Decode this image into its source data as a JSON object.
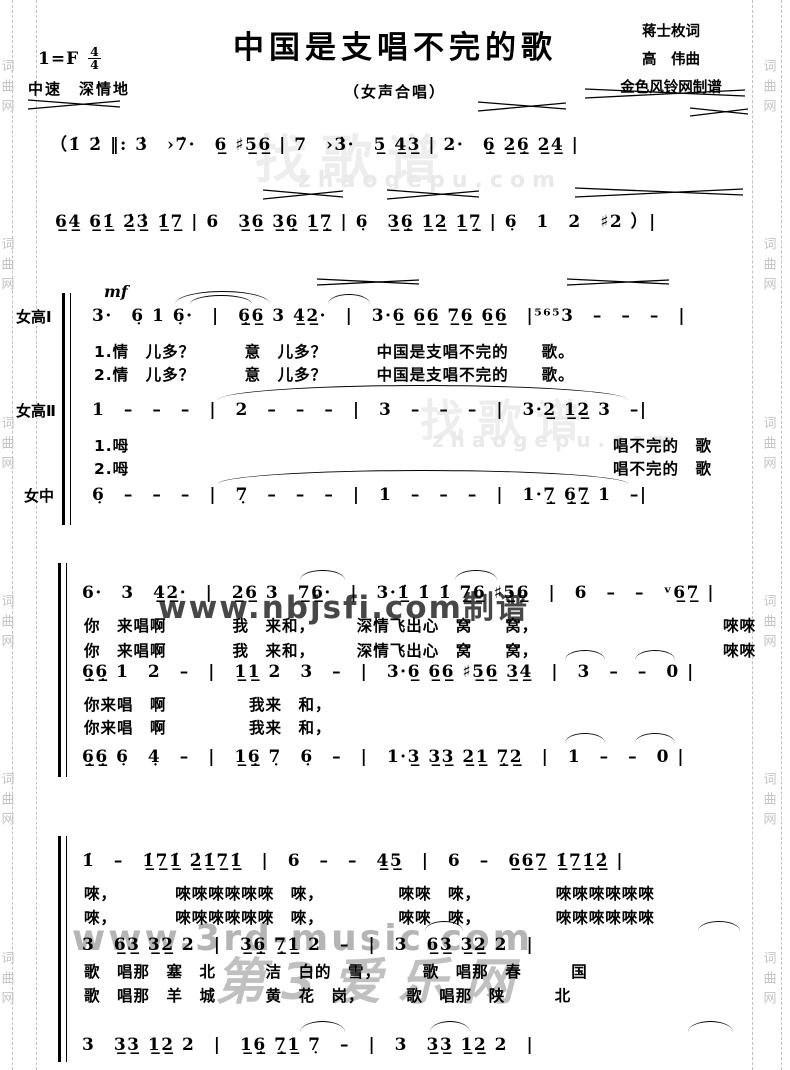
{
  "header": {
    "title": "中国是支唱不完的歌",
    "subtitle": "（女声合唱）",
    "key": "1=F",
    "meter_num": "4",
    "meter_den": "4",
    "tempo": "中速　深情地",
    "credit_lyricist": "蒋士枚词",
    "credit_composer": "高　伟曲",
    "credit_publisher": "金色风铃网制谱"
  },
  "intro": {
    "line1": "（1̇ 2̇ ‖: 3̇　›7̇·　6̲ ♯5̲6̲ | 7　›3̇·　5̲ 4̲3̲ | 2·　6̣̲ 2̲6̣̲ 2̲4̲ |",
    "line2": "6̲4̲ 6̲1̲̇ 2̲̇3̲̇ 1̲̇7̲ | 6　3̲6̲ 3̲6̣̲ 1̲7̣̲ | 6̣　3̲6̣̲ 1̲2̲ 1̲7̣̲ | 6̣　1　2　♯2 ）|"
  },
  "system1": {
    "dynamic": "mf",
    "sop1_label": "女高Ⅰ",
    "sop1_notes": "3·　6̣ 1 6̣·　|　6̣̲6̲ 3 4̲2̲·　|　3·6̲ 6̲6̲ 7̲6̲ 6̲6̲　|⁵⁶⁵3　–　–　–　|",
    "sop1_lyric1": "1.情　儿多？　　　意　儿多？　　　中国是支唱不完的　　歌。",
    "sop1_lyric2": "2.情　儿多？　　　意　儿多？　　　中国是支唱不完的　　歌。",
    "sop2_label": "女高Ⅱ",
    "sop2_notes": "1　–　–　–　|　2　–　–　–　|　3　–　–　–　|　3·2̲ 1̲2̲ 3　–|",
    "sop2_lyric1_left": "1.呣",
    "sop2_lyric1_right": "唱不完的　歌",
    "sop2_lyric2_left": "2.呣",
    "sop2_lyric2_right": "唱不完的　歌",
    "alto_label": "女中",
    "alto_notes": "6̣　–　–　–　|　7̣　–　–　–　|　1　–　–　–　|　1·7̣̲ 6̣̲7̣̲ 1　–|"
  },
  "system2": {
    "lineA_notes": "6·　3　4̲2̲·　|　2̲6̲ 3　7̲6̲·　|　3·1̲̇ 1̇ 1̇ 7̲6̲ ♯5̲6̲　|　6　–　–　ᵛ6̲7̲ |",
    "lineA_lyric1_left": "你　来唱啊　　　　我　来和，　　　深情飞出心　窝　　窝，",
    "lineA_lyric1_right": "唻唻",
    "lineA_lyric2_left": "你　来唱啊　　　　我　来和，　　　深情飞出心　窝　　窝，",
    "lineA_lyric2_right": "唻唻",
    "lineB_notes": "6̣̲6̣̲ 1　2　–　|　1̲1̲ 2　3　–　|　3·6̲ 6̲6̲ ♯5̲6̲ 3̲4̲　|　3　–　–　0 |",
    "lineB_lyric1": "你来唱　啊　　　　　我来　和，",
    "lineB_lyric2": "你来唱　啊　　　　　我来　和，",
    "lineC_notes": "6̣̲6̣̲ 6̣　4̣　–　|　1̲6̣̲ 7̣　6̣　–　|　1·3̲ 3̲3̲ 2̲1̲ 7̣̲2̲　|　1　–　–　0 |"
  },
  "system3": {
    "lineA_notes": "1̇　–　1̲̇7̲1̲̇ 2̲̇1̲̇7̲1̲̇　|　6　–　–　4̲5̲　|　6　–　6̲6̲7̲ 1̲̇7̲1̲̇2̲̇ |",
    "lineA_lyric1": "唻，　　　　唻唻唻唻唻唻　唻，　　　　　唻唻　唻，　　　　　唻唻唻唻唻唻",
    "lineA_lyric2": "唻，　　　　唻唻唻唻唻唻　唻，　　　　　唻唻　唻，　　　　　唻唻唻唻唻唻",
    "lineB_notes": "3　6̲3̲ 3̲2̲ 2　|　3̲6̣̲ 7̣̲1̲ 2　–　|　3　6̲3̲ 3̲2̲ 2　|",
    "lineB_lyric1": "歌　唱那　塞　北　　　洁　白的　雪，　　　歌　唱那　春　　　国",
    "lineB_lyric2": "歌　唱那　羊　城　　　黄　花　岗，　　　歌　唱那　陕　　　北",
    "lineC_notes": "3　3̲3̲ 1̲2̲ 2　|　1̲6̣̲ 7̣̲1̲ 7̣　–　|　3　3̲3̲ 1̲2̲ 2　|"
  },
  "watermarks": {
    "side_text": "词曲网",
    "zhaogepu_name": "找歌谱",
    "zhaogepu_url": "zhaogepu.com",
    "nbjs": "www.nbjsfi.com制谱",
    "music3rd_url": "www.3rd-music.com",
    "music3rd_name": "第3爱乐网"
  }
}
